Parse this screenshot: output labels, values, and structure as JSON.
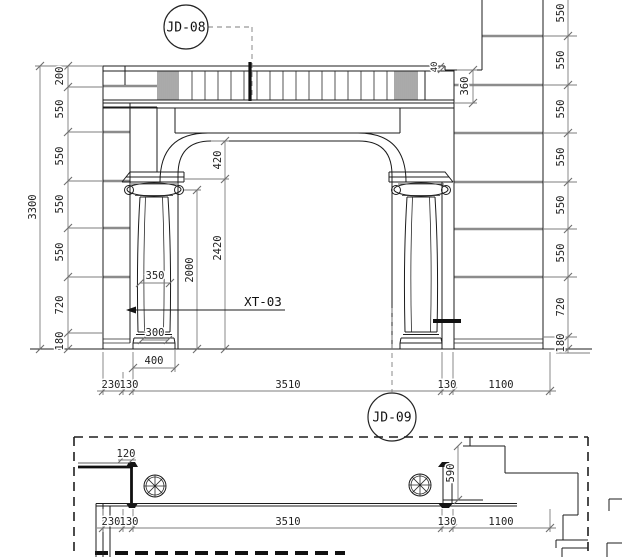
{
  "markers": {
    "jd08": "JD-08",
    "jd09": "JD-09",
    "material": "XT-03"
  },
  "elevation": {
    "overall_height": "3300",
    "left_chain": [
      "200",
      "550",
      "550",
      "550",
      "550",
      "720",
      "180"
    ],
    "right_chain": [
      "550",
      "550",
      "550",
      "550",
      "550",
      "550",
      "720",
      "180"
    ],
    "cornice_step": "40",
    "corner_return": "360",
    "arch_drop": "420",
    "opening_height": "2420",
    "column_height": "2000",
    "shaft_width_upper": "350",
    "shaft_width_lower": "300",
    "plinth_width": "400",
    "bottom_chain": [
      "230",
      "130",
      "3510",
      "130",
      "1100"
    ]
  },
  "plan": {
    "jamb_thickness": "120",
    "return_depth": "590",
    "bottom_chain": [
      "230",
      "130",
      "3510",
      "130",
      "1100"
    ]
  },
  "colors": {
    "line": "#1c1c1c",
    "block_joint": "#8c8c8c",
    "dimension": "#7d7d7d",
    "text": "#222222",
    "background": "#ffffff"
  }
}
